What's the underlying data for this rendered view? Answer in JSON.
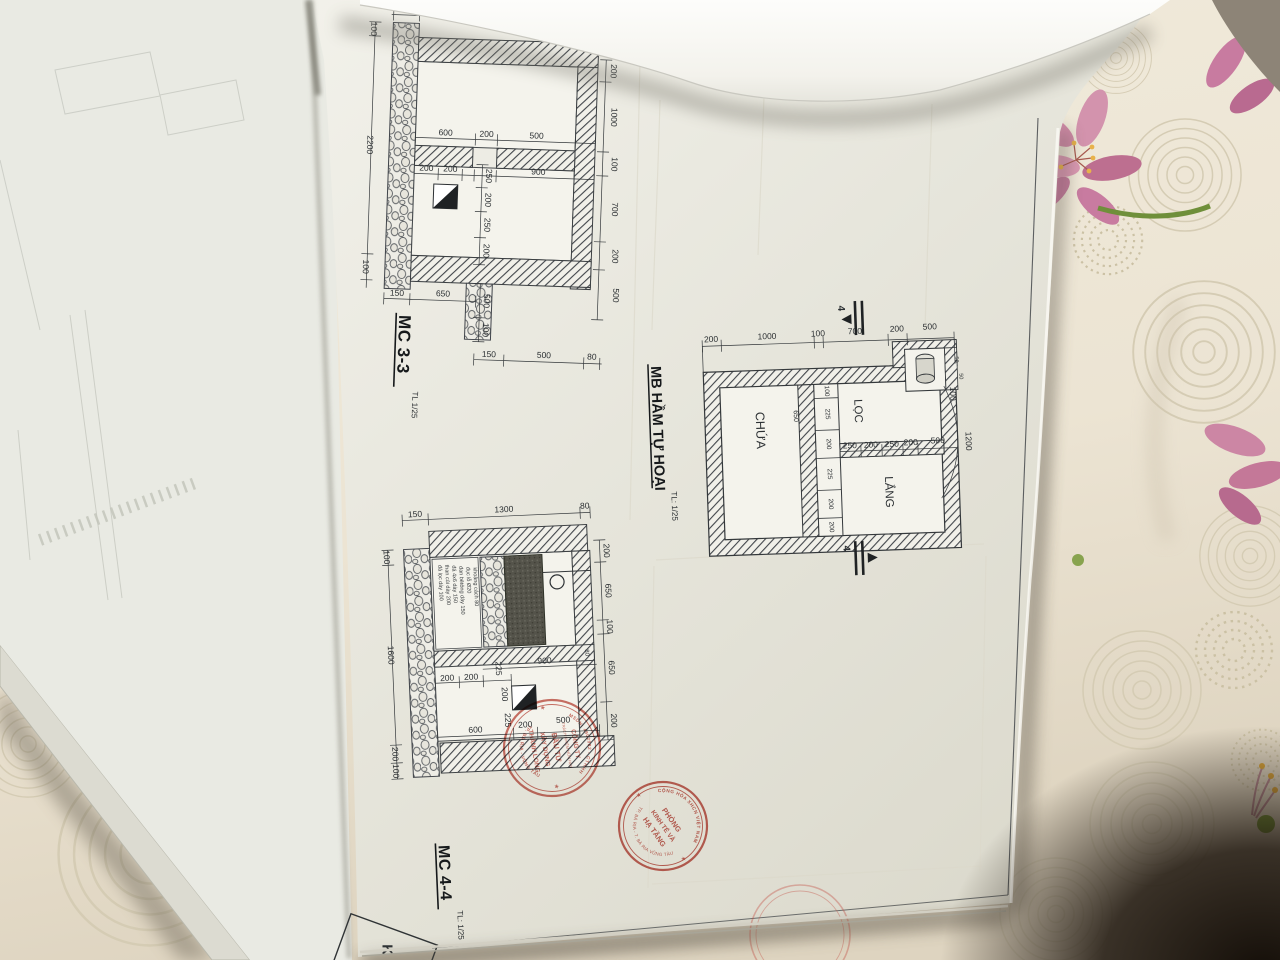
{
  "colors": {
    "stamp_red": "#bf4a3f",
    "paper": "#e9e8e0",
    "fabric": "#ece4d4",
    "line": "#2c3033"
  },
  "mc33": {
    "title": "MC 3-3",
    "scale": "TL 1/25",
    "dims": {
      "top_150": "150",
      "left_100a": "100",
      "left_2200": "2200",
      "left_100b": "100",
      "mid_600": "600",
      "mid_200": "200",
      "mid_500": "500",
      "in_200a": "200",
      "in_200b": "200",
      "in_900": "900",
      "v_250a": "250",
      "v_200a": "200",
      "v_250b": "250",
      "v_200b": "200",
      "low_150": "150",
      "low_650": "650",
      "low_500": "500",
      "low_100": "100",
      "bot_150": "150",
      "bot_500": "500",
      "bot_80": "80",
      "r_200a": "200",
      "r_1000": "1000",
      "r_100": "100",
      "r_700": "700",
      "r_200b": "200",
      "r_500": "500"
    }
  },
  "plan": {
    "title": "MB HẦM TỰ HOẠI",
    "scale": "TL: 1/25",
    "section_mark": "4",
    "rooms": {
      "chua": "CHỨA",
      "loc": "LỌC",
      "lang": "LẮNG"
    },
    "dims": {
      "t_200a": "200",
      "t_1000": "1000",
      "t_100": "100",
      "t_700": "700",
      "t_200b": "200",
      "t_500": "500",
      "r_100": "100",
      "r_1200": "1200",
      "r_50a": "50",
      "r_50b": "50",
      "c_650": "650",
      "c_100": "100",
      "c_225a": "225",
      "c_200a": "200",
      "c_225b": "225",
      "c_200b": "200",
      "c_200c": "200",
      "m_250a": "250",
      "m_200a": "200",
      "m_250b": "250",
      "m_200b": "200",
      "m_500": "500"
    }
  },
  "mc44": {
    "title": "MC 4-4",
    "scale": "TL: 1/25",
    "dims": {
      "top_150": "150",
      "top_1300": "1300",
      "top_80": "80",
      "left_100a": "100",
      "left_1600": "1600",
      "left_200": "200",
      "left_100b": "100",
      "r_200a": "200",
      "r_650a": "650",
      "r_100": "100",
      "r_650b": "650",
      "r_200b": "200",
      "r_80": "80",
      "in_200a": "200",
      "in_200b": "200",
      "in_225a": "225",
      "in_900": "900",
      "in_200c": "200",
      "in_225b": "225",
      "bot_600": "600",
      "bot_200": "200",
      "bot_500": "500"
    },
    "notes": [
      "đá lọc dày 100",
      "than củi dày 200",
      "đá 4x6 dày 150",
      "đan bêtông dày 150",
      "đục lỗ Ø20",
      "khoảng cách 80"
    ]
  },
  "corner_box": {
    "label": "K"
  },
  "stamps": {
    "company": {
      "ring_top": "MSDN: 4902982 - CTHHH",
      "ring_bottom": "TP. BÀ RỊA - VŨNG TÀU",
      "line1": "CÔNG TY",
      "line2": "TRÁCH NHIỆM HỮU HẠN",
      "line3": "ĐẦU TƯ",
      "line4": "XÂY DỰNG",
      "line5": "THÀNH LONG"
    },
    "department": {
      "ring_top": "CỘNG HÒA XHCN VIỆT NAM",
      "ring_bottom": "TP. BÀ RỊA - T. BÀ RỊA VŨNG TÀU",
      "line1": "PHÒNG",
      "line2": "KINH TẾ VÀ",
      "line3": "HẠ TẦNG"
    }
  }
}
